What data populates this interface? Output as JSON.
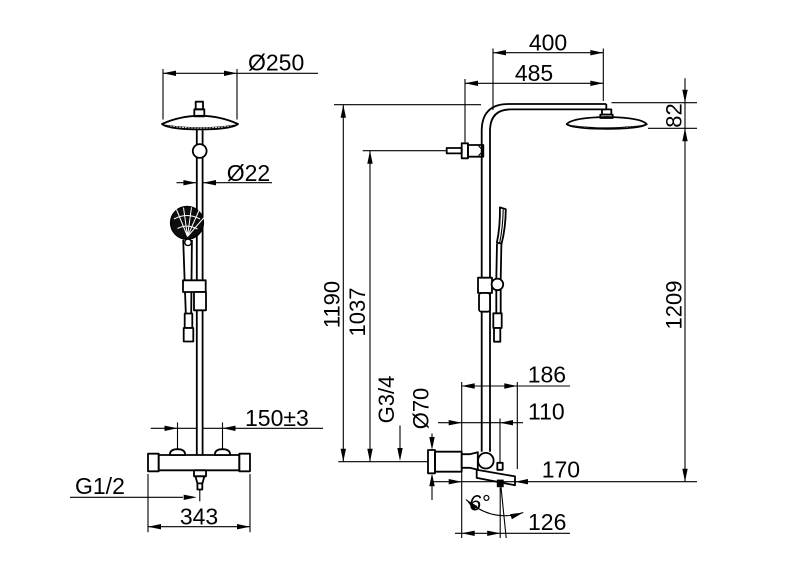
{
  "drawing": {
    "type": "technical-dimension-drawing",
    "subject": "Shower column with overhead rain shower, hand shower and bath spout mixer - front view and side view",
    "line_color": "#000000",
    "background_color": "#ffffff",
    "front_view": {
      "head_diameter": "Ø250",
      "pipe_diameter": "Ø22",
      "supply_centre_distance": "150±3",
      "hose_thread": "G1/2",
      "mixer_width": "343"
    },
    "side_view": {
      "arm_reach": "400",
      "head_reach": "485",
      "head_height": "82",
      "height_to_arm": "1190",
      "height_to_supply": "1037",
      "overall_height": "1209",
      "supply_thread": "G3/4",
      "mixer_diameter": "Ø70",
      "mixer_depth": "186",
      "outlet_offset": "110",
      "spout_reach": "170",
      "spout_angle": "6°",
      "outlet_reach": "126"
    }
  }
}
